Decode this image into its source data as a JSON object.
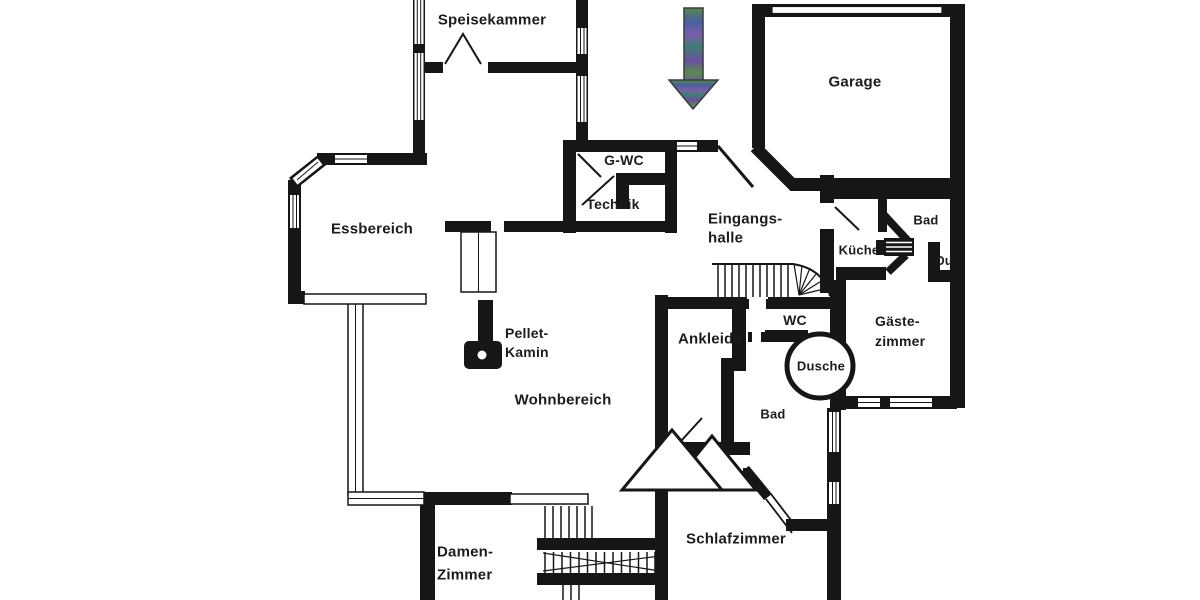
{
  "document_type": "floor-plan",
  "rooms": {
    "speisekammer": {
      "label": "Speisekammer"
    },
    "garage": {
      "label": "Garage"
    },
    "gwc": {
      "label": "G-WC"
    },
    "technik": {
      "label": "Technik"
    },
    "essbereich": {
      "label": "Essbereich"
    },
    "eingangshalle": {
      "line1": "Eingangs-",
      "line2": "halle"
    },
    "bad_upper": {
      "label": "Bad"
    },
    "kueche": {
      "label": "Küche"
    },
    "du": {
      "label": "Du."
    },
    "gaestezimmer": {
      "line1": "Gäste-",
      "line2": "zimmer"
    },
    "wc": {
      "label": "WC"
    },
    "ankleide": {
      "label": "Ankleide"
    },
    "dusche": {
      "label": "Dusche"
    },
    "pellet_kamin": {
      "line1": "Pellet-",
      "line2": "Kamin"
    },
    "wohnbereich": {
      "label": "Wohnbereich"
    },
    "bad_lower": {
      "label": "Bad"
    },
    "schlafzimmer": {
      "label": "Schlafzimmer"
    },
    "damenzimmer": {
      "line1": "Damen-",
      "line2": "Zimmer"
    }
  },
  "icons": {
    "entrance_arrow": "down-arrow"
  },
  "colors": {
    "walls": "#161616",
    "background": "#ffffff",
    "text": "#1c1c1c",
    "arrow_gradient": [
      "#57864f",
      "#4a5f9e",
      "#7a5fa8",
      "#3f7d74",
      "#6b4fa0",
      "#5a8a52"
    ]
  }
}
